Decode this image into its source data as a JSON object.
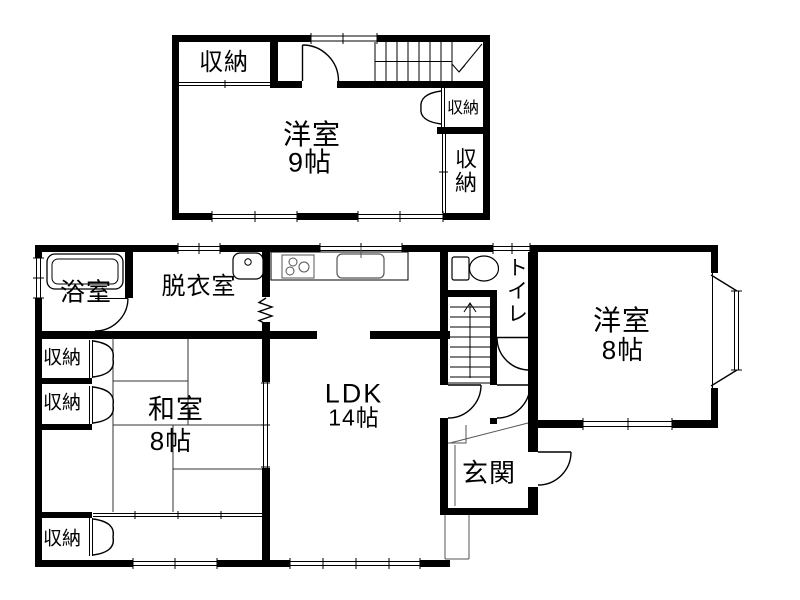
{
  "drawing": {
    "kind": "floor-plan",
    "colors": {
      "wall": "#000000",
      "background": "#ffffff",
      "line": "#000000"
    }
  },
  "floor2": {
    "closet_top_left": "収納",
    "western_room": "洋室",
    "western_room_size": "9帖",
    "closet_small": "収納",
    "closet_tall": "収納"
  },
  "floor1": {
    "bathroom": "浴室",
    "dressing_room": "脱衣室",
    "toilet": "トイレ",
    "closet_upper": "収納",
    "closet_middle": "収納",
    "closet_lower": "収納",
    "japanese_room": "和室",
    "japanese_room_size": "8帖",
    "ldk": "LDK",
    "ldk_size": "14帖",
    "entrance": "玄関",
    "western_room": "洋室",
    "western_room_size": "8帖"
  }
}
